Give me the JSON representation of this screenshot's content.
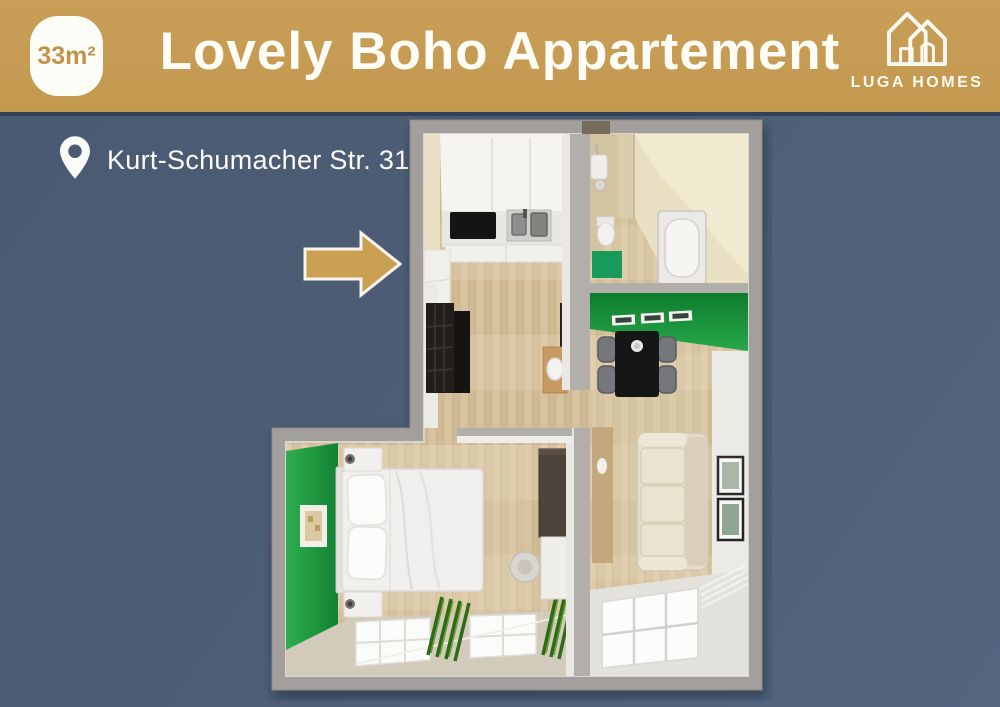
{
  "banner": {
    "area_badge_label": "33m²",
    "title": "Lovely Boho Appartement",
    "logo_text": "LUGA HOMES"
  },
  "listing": {
    "address": "Kurt-Schumacher Str. 31"
  },
  "icons": {
    "area_badge": "rounded-square-badge",
    "logo": "double-house-outline-icon",
    "location": "map-pin-icon",
    "arrow": "right-arrow-icon"
  },
  "colors": {
    "banner_gold": "#c79c54",
    "badge_text_gold": "#c2924a",
    "background_slate": "#4d5e76",
    "divider_navy": "#31415a",
    "accent_green": "#1f9a40",
    "bath_mat_green": "#189a5b",
    "wall_gray": "#a39f9c",
    "bath_wall_beige": "#e9dfc3",
    "floor_wood": "#d7c3a0",
    "text_white": "#fdfcf6"
  }
}
